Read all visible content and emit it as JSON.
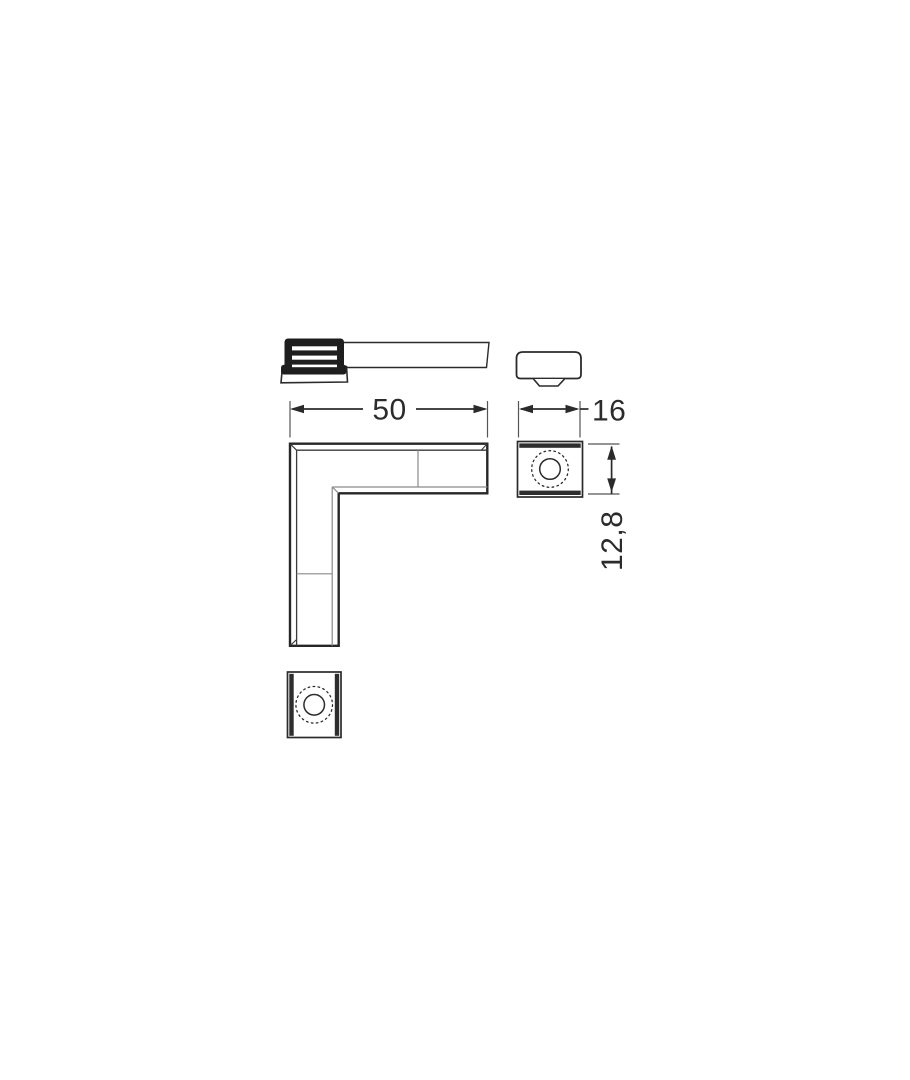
{
  "drawing": {
    "title": "L-corner connector technical drawing",
    "colors": {
      "line_dark": "#2b2b2b",
      "line_thin": "#8a8a8a",
      "cap_fill": "#1e1e1e",
      "background": "#ffffff"
    },
    "dimensions": {
      "width": {
        "label": "50"
      },
      "depth": {
        "label": "16"
      },
      "height": {
        "label": "12,8"
      }
    }
  }
}
